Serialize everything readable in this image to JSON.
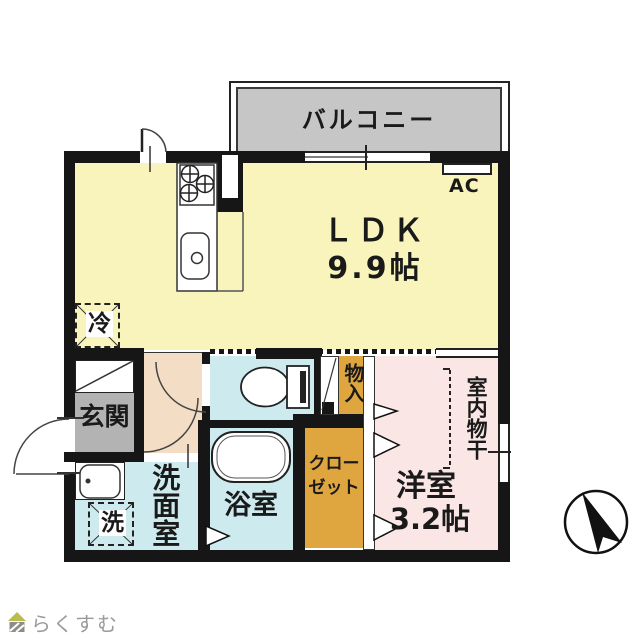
{
  "floorplan": {
    "balcony_label": "バルコニー",
    "ldk_label": "ＬＤＫ",
    "ldk_size": "9.9帖",
    "ac_label": "AC",
    "fridge_label": "冷",
    "entrance_label": "玄関",
    "washroom_label": "洗面室",
    "washer_label": "洗",
    "bath_label": "浴室",
    "closet_line1": "クロー",
    "closet_line2": "ゼット",
    "storage_label": "物入",
    "western_label": "洋室",
    "western_size": "3.2帖",
    "drying_label": "室内物干"
  },
  "branding": {
    "logo_text": "らくすむ"
  },
  "colors": {
    "ldk_floor": "#f8f4bb",
    "wet_floor": "#cdebee",
    "hall_floor": "#f3ddc4",
    "western_floor": "#f9e6e5",
    "closet_floor": "#dfa53e",
    "entrance_floor": "#b3b3b3",
    "balcony": "#c6c6c6",
    "wall": "#161616",
    "logo_text": "#9b9b97",
    "logo_roof": "#b8bd4e"
  }
}
